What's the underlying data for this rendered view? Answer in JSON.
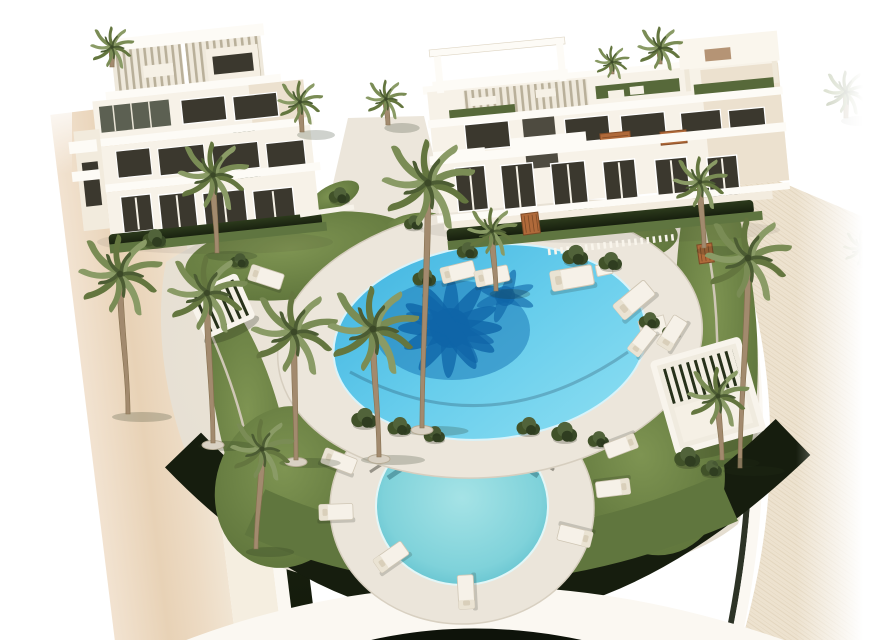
{
  "scene": {
    "setting": "Aerial 3D architectural rendering of a modern white residential complex: two apartment buildings with rooftop pergolas, a large oval swimming pool with a palm-tree reflection, a smaller round pool ringed by lawn and sun loungers, many palm trees, a beige road on the left and a curved paved promenade with white perimeter wall and dark hedge at the bottom",
    "palette": {
      "background": "#ffffff",
      "road_light": "#f2e3d1",
      "road_mid": "#e8d2b6",
      "road_pale": "#f5eee0",
      "wall_white": "#fbf8f2",
      "hedge_dark": "#161d0e",
      "deck": "#e8e2d6",
      "deck_light": "#ece6db",
      "grass_light": "#7e9452",
      "grass_mid": "#60763e",
      "grass_dark": "#31401f",
      "pool_deep": "#3fb3e0",
      "pool_light": "#8edff2",
      "pool_palm_shadow": "#0f65a8",
      "round_pool": "#7fd2da",
      "building_white": "#f7f2e8",
      "building_shade": "#ece1cf",
      "slab_white": "#fdfbf6",
      "window_dark": "#3b382e",
      "wood_stair": "#b06a3a",
      "roof_lawn": "#57693a",
      "front_grass": "#5f7540",
      "palm_trunk": "#a28a6e",
      "palm_frond": "#7a8c55",
      "palm_frond_dark": "#64763f",
      "lounger_white": "#f6f1e8"
    },
    "palms": [
      {
        "x": 112,
        "y": 47,
        "s": 0.48,
        "t": 20,
        "l": 0
      },
      {
        "x": 660,
        "y": 48,
        "s": 0.5,
        "t": 16,
        "l": 0
      },
      {
        "x": 612,
        "y": 62,
        "s": 0.38,
        "t": 12,
        "l": 0
      },
      {
        "x": 846,
        "y": 92,
        "s": 0.5,
        "t": 26,
        "l": 0,
        "o": 0.5
      },
      {
        "x": 386,
        "y": 99,
        "s": 0.45,
        "t": 26,
        "l": 2
      },
      {
        "x": 300,
        "y": 102,
        "s": 0.5,
        "t": 30,
        "l": 2
      },
      {
        "x": 213,
        "y": 175,
        "s": 0.78,
        "t": 78,
        "l": 4
      },
      {
        "x": 700,
        "y": 182,
        "s": 0.6,
        "t": 66,
        "l": 4
      },
      {
        "x": 428,
        "y": 183,
        "s": 1.02,
        "t": 245,
        "l": -6,
        "b": 1
      },
      {
        "x": 492,
        "y": 231,
        "s": 0.55,
        "t": 60,
        "l": 4
      },
      {
        "x": 862,
        "y": 248,
        "s": 0.42,
        "t": 20,
        "l": 0,
        "o": 0.35
      },
      {
        "x": 748,
        "y": 258,
        "s": 0.95,
        "t": 210,
        "l": -8
      },
      {
        "x": 120,
        "y": 274,
        "s": 0.92,
        "t": 140,
        "l": 8
      },
      {
        "x": 207,
        "y": 293,
        "s": 0.88,
        "t": 150,
        "l": 6,
        "b": 1
      },
      {
        "x": 294,
        "y": 332,
        "s": 0.95,
        "t": 128,
        "l": 2,
        "b": 1
      },
      {
        "x": 373,
        "y": 329,
        "s": 1.0,
        "t": 128,
        "l": 6,
        "b": 1
      },
      {
        "x": 718,
        "y": 396,
        "s": 0.68,
        "t": 64,
        "l": 4
      },
      {
        "x": 262,
        "y": 449,
        "s": 0.7,
        "t": 100,
        "l": -6
      }
    ],
    "loungers": [
      {
        "x": 266,
        "y": 277,
        "r": 18,
        "s": 1
      },
      {
        "x": 458,
        "y": 272,
        "r": -14,
        "s": 1
      },
      {
        "x": 492,
        "y": 276,
        "r": -12,
        "s": 1
      },
      {
        "x": 572,
        "y": 278,
        "r": -10,
        "s": 1.25
      },
      {
        "x": 634,
        "y": 300,
        "r": -40,
        "s": 1.2
      },
      {
        "x": 672,
        "y": 333,
        "r": -58,
        "s": 1
      },
      {
        "x": 642,
        "y": 341,
        "r": -52,
        "s": 0.9
      },
      {
        "x": 339,
        "y": 461,
        "r": 21,
        "s": 1
      },
      {
        "x": 336,
        "y": 512,
        "r": -2,
        "s": 1
      },
      {
        "x": 391,
        "y": 557,
        "r": -35,
        "s": 1
      },
      {
        "x": 466,
        "y": 592,
        "r": -93,
        "s": 1
      },
      {
        "x": 575,
        "y": 536,
        "r": -166,
        "s": 1
      },
      {
        "x": 613,
        "y": 488,
        "r": 173,
        "s": 1
      },
      {
        "x": 621,
        "y": 446,
        "r": 159,
        "s": 0.95
      }
    ],
    "bushes": [
      {
        "x": 155,
        "y": 240,
        "s": 1
      },
      {
        "x": 240,
        "y": 262,
        "s": 0.8
      },
      {
        "x": 340,
        "y": 197,
        "s": 0.9
      },
      {
        "x": 414,
        "y": 224,
        "s": 0.8
      },
      {
        "x": 425,
        "y": 279,
        "s": 1
      },
      {
        "x": 468,
        "y": 252,
        "s": 0.9
      },
      {
        "x": 576,
        "y": 257,
        "s": 1.1
      },
      {
        "x": 611,
        "y": 263,
        "s": 1
      },
      {
        "x": 365,
        "y": 420,
        "s": 1.1
      },
      {
        "x": 400,
        "y": 428,
        "s": 1
      },
      {
        "x": 435,
        "y": 436,
        "s": 0.9
      },
      {
        "x": 529,
        "y": 428,
        "s": 1
      },
      {
        "x": 565,
        "y": 434,
        "s": 1.1
      },
      {
        "x": 599,
        "y": 441,
        "s": 0.9
      },
      {
        "x": 688,
        "y": 459,
        "s": 1.1
      },
      {
        "x": 712,
        "y": 470,
        "s": 0.9
      },
      {
        "x": 650,
        "y": 322,
        "s": 0.9
      },
      {
        "x": 672,
        "y": 332,
        "s": 0.8
      }
    ]
  }
}
